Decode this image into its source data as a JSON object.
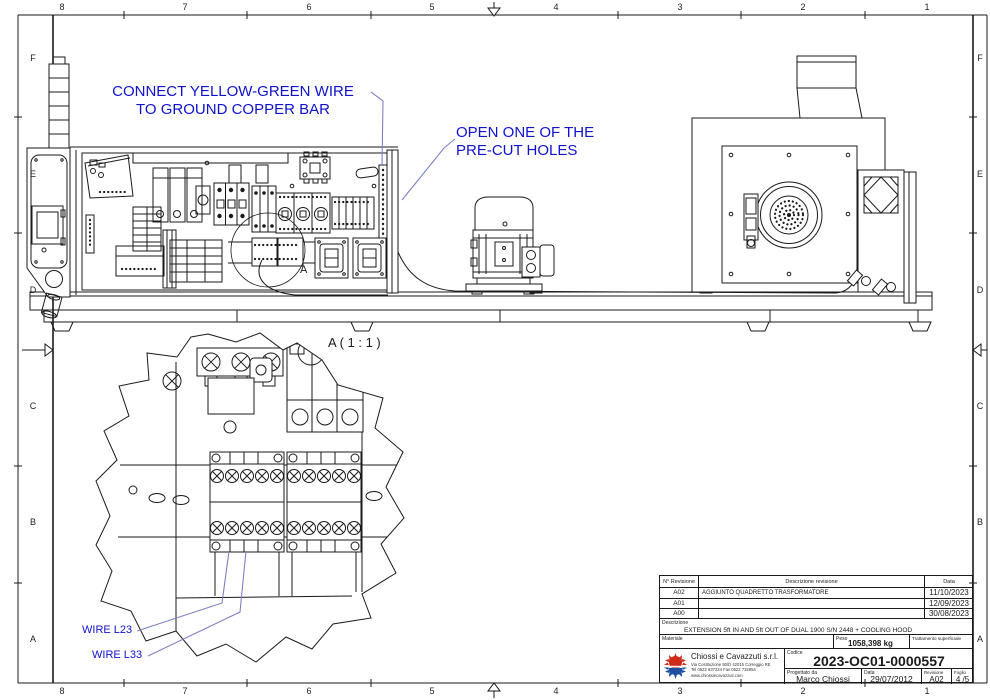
{
  "zones": {
    "top": [
      "8",
      "7",
      "6",
      "5",
      "4",
      "3",
      "2",
      "1"
    ],
    "bottom": [
      "8",
      "7",
      "6",
      "5",
      "4",
      "3",
      "2",
      "1"
    ],
    "left": [
      "F",
      "E",
      "D",
      "C",
      "B",
      "A"
    ],
    "right": [
      "F",
      "E",
      "D",
      "C",
      "B",
      "A"
    ]
  },
  "annotations": {
    "connect": {
      "line1": "CONNECT YELLOW-GREEN WIRE",
      "line2": "TO GROUND COPPER BAR"
    },
    "open": {
      "line1": "OPEN ONE OF THE",
      "line2": "PRE-CUT HOLES"
    },
    "wire_l23": "WIRE L23",
    "wire_l33": "WIRE L33",
    "detail_title": "A ( 1 : 1 )",
    "detail_marker": "A"
  },
  "titleblock": {
    "rev_header": {
      "rev": "N° Revisione",
      "desc": "Descrizione revisione",
      "date": "Data"
    },
    "revisions": [
      {
        "rev": "A02",
        "desc": "AGGIUNTO QUADRETTO TRASFORMATORE",
        "date": "11/10/2023"
      },
      {
        "rev": "A01",
        "desc": "",
        "date": "12/09/2023"
      },
      {
        "rev": "A00",
        "desc": "",
        "date": "30/08/2023"
      }
    ],
    "description_label": "Descrizione",
    "description_value": "EXTENSION 5ft IN AND 5ft OUT OF DUAL 1900 S/N 2448 + COOLING HOOD",
    "material_label": "Materiale",
    "weight_label": "Peso",
    "weight_value": "1058,398 kg",
    "surface_label": "Trattamento superficiale",
    "company": {
      "name": "Chiossi e Cavazzuti s.r.l.",
      "address": "Via Costituzione 50/D 42015 Correggio RE",
      "phone": "Tel 0522 637224 Fax 0522 732854",
      "web": "www.chiossiecavazzuti.com"
    },
    "code_label": "Codice",
    "code_value": "2023-OC01-0000557",
    "designer_label": "Progettato da",
    "designer_value": "Marco Chiossi",
    "date_label": "Data",
    "date_value": "29/07/2012",
    "revision_label": "Revisione",
    "revision_value": "A02",
    "sheet_label": "Foglio",
    "sheet_value": "4 /5"
  },
  "colors": {
    "annotation_blue": "#0f12cf",
    "leader_violet": "#7d82c4",
    "line_black": "#1a1a1a",
    "logo_red": "#cf2a1b",
    "logo_blue": "#1d4fa0"
  }
}
